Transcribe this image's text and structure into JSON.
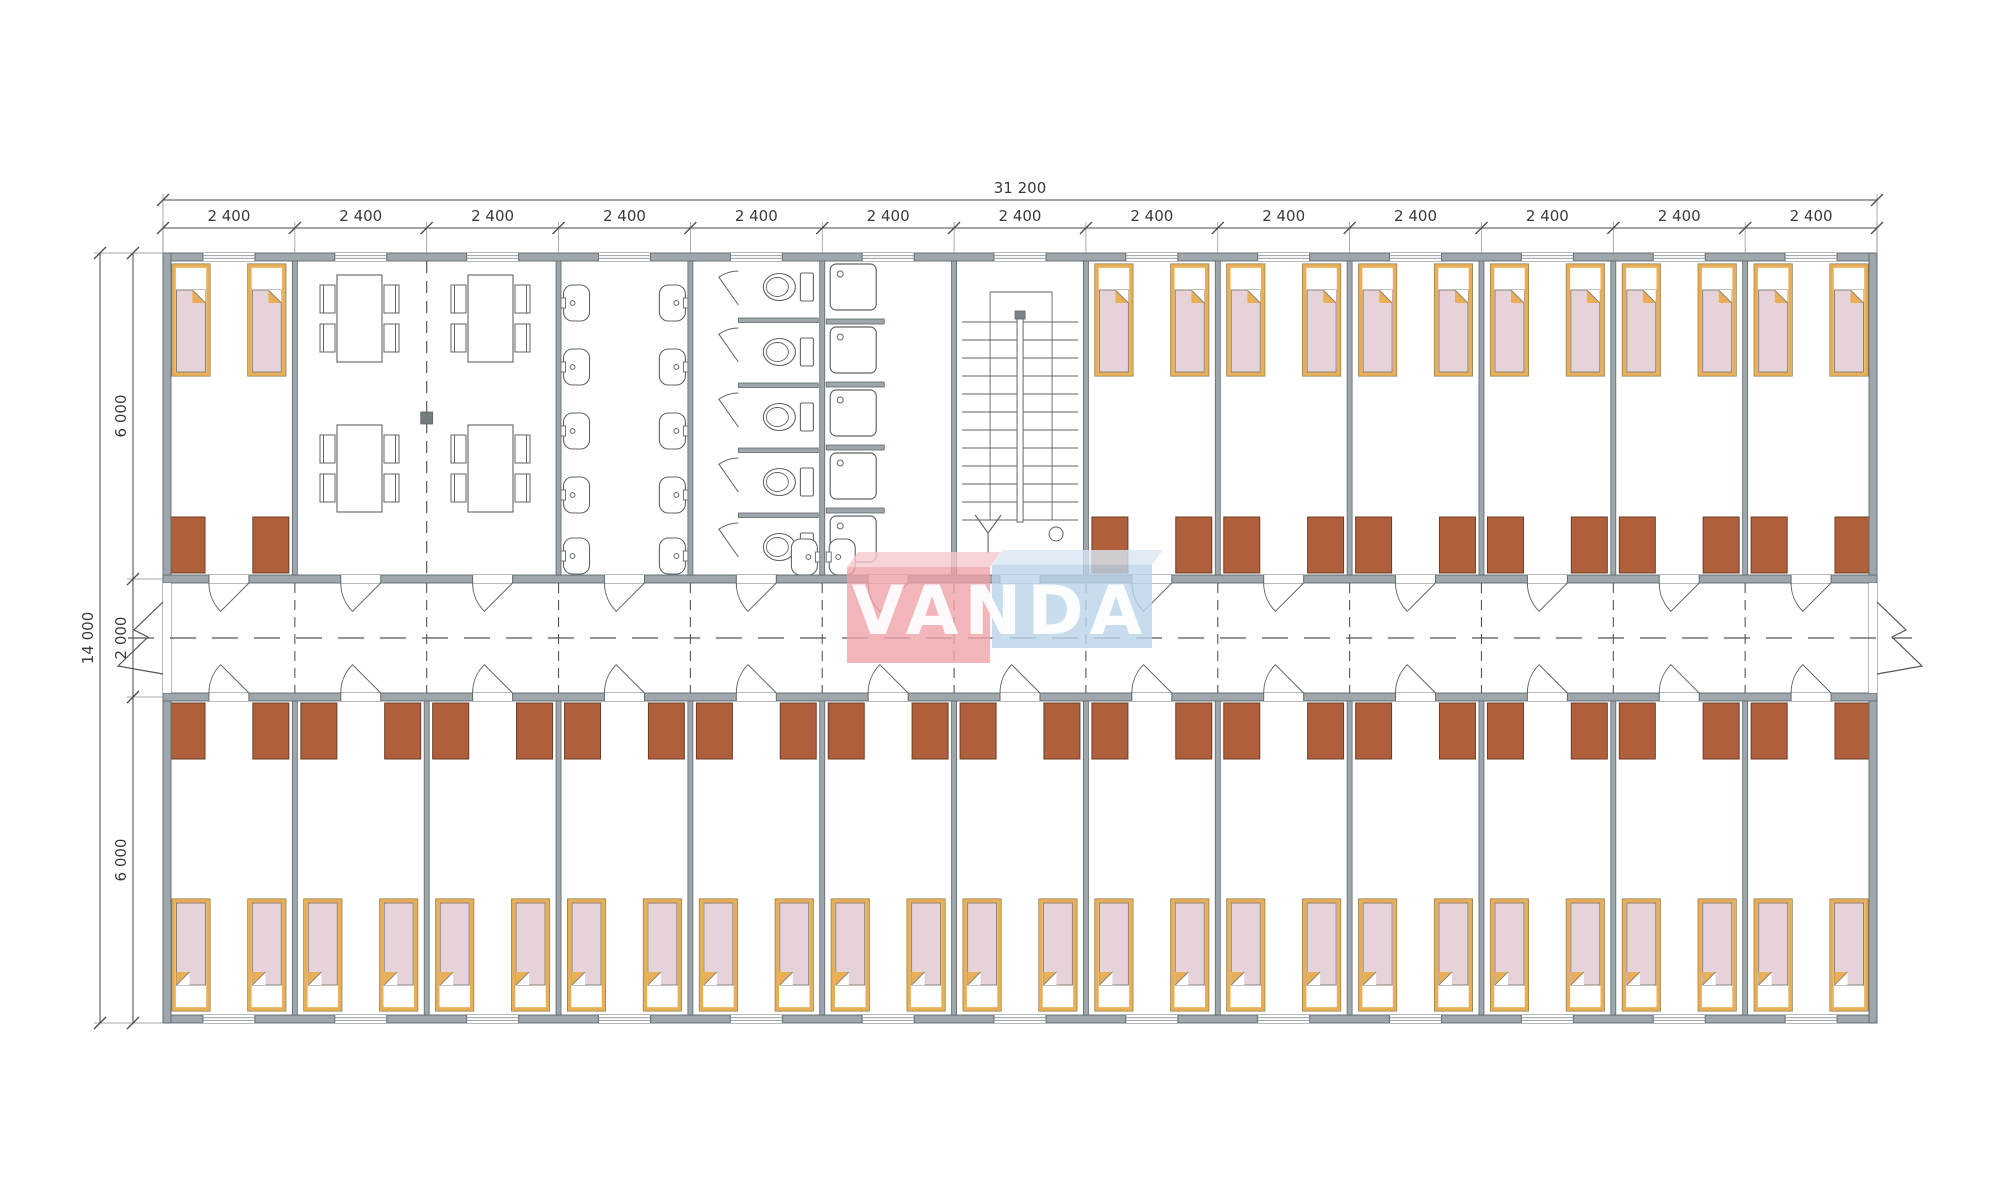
{
  "logo": {
    "text": "VANDA",
    "red_front": "#EFA3A9",
    "red_top": "#F6C9CE",
    "blue_front": "#BCD3EA",
    "blue_top": "#D8E6F4"
  },
  "dimensions": {
    "overall_width": "31 200",
    "segments": [
      "2 400",
      "2 400",
      "2 400",
      "2 400",
      "2 400",
      "2 400",
      "2 400",
      "2 400",
      "2 400",
      "2 400",
      "2 400",
      "2 400",
      "2 400"
    ],
    "overall_height": "14 000",
    "left_segments": [
      "6 000",
      "2 000",
      "6 000"
    ]
  },
  "plan": {
    "module_count": 13,
    "top_row": [
      "bedroom",
      "dining",
      "dining",
      "washbasins",
      "wc",
      "showers",
      "stairs",
      "bedroom",
      "bedroom",
      "bedroom",
      "bedroom",
      "bedroom",
      "bedroom"
    ],
    "bottom_row": [
      "bedroom",
      "bedroom",
      "bedroom",
      "bedroom",
      "bedroom",
      "bedroom",
      "bedroom",
      "bedroom",
      "bedroom",
      "bedroom",
      "bedroom",
      "bedroom",
      "bedroom"
    ],
    "fixtures": {
      "beds_per_bedroom": 2,
      "wardrobes_per_bedroom": 2,
      "dining_tables": 4,
      "chairs_per_table": 4,
      "washbasins": 10,
      "toilet_stalls": 5,
      "shower_trays": 5,
      "extra_basins": 2
    },
    "colors": {
      "wall": "#9DA7AC",
      "wall_edge": "#5F686C",
      "wardrobe": "#AF5F3B",
      "wardrobe_edge": "#6E3C26",
      "bed_gold": "#E9AF56",
      "bed_frame_edge": "#8F7F52",
      "bed_blanket": "#E5D3D9",
      "blanket_edge": "#8A8178",
      "fixture_line": "#5F6568",
      "axis_line": "#555555",
      "dim_line": "#4A4A4A",
      "ext_line": "#8A8A8A"
    }
  }
}
